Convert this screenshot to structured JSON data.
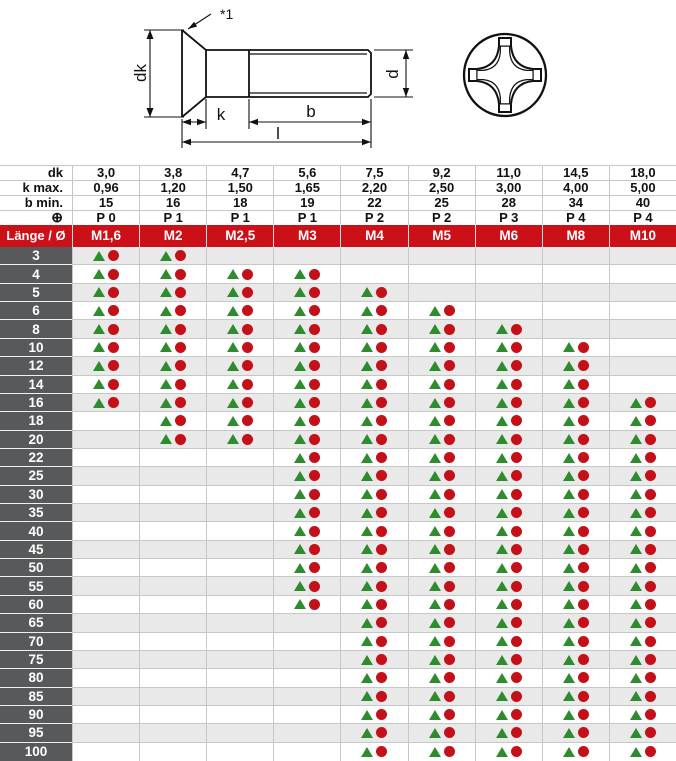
{
  "drawing": {
    "labels": {
      "ref_mark": "*1",
      "dk": "dk",
      "k_dim": "k",
      "b_dim": "b",
      "l_dim": "l",
      "d_dim": "d"
    }
  },
  "table": {
    "spec_rows": [
      {
        "label": "dk",
        "values": [
          "3,0",
          "3,8",
          "4,7",
          "5,6",
          "7,5",
          "9,2",
          "11,0",
          "14,5",
          "18,0"
        ]
      },
      {
        "label": "k max.",
        "values": [
          "0,96",
          "1,20",
          "1,50",
          "1,65",
          "2,20",
          "2,50",
          "3,00",
          "4,00",
          "5,00"
        ]
      },
      {
        "label": "b min.",
        "values": [
          "15",
          "16",
          "18",
          "19",
          "22",
          "25",
          "28",
          "34",
          "40"
        ]
      },
      {
        "label": "⊕",
        "values": [
          "P 0",
          "P 1",
          "P 1",
          "P 1",
          "P 2",
          "P 2",
          "P 3",
          "P 4",
          "P 4"
        ]
      }
    ],
    "header": {
      "corner": "Länge / Ø",
      "columns": [
        "M1,6",
        "M2",
        "M2,5",
        "M3",
        "M4",
        "M5",
        "M6",
        "M8",
        "M10"
      ]
    },
    "rows": [
      {
        "length": "3",
        "marks": [
          1,
          1,
          0,
          0,
          0,
          0,
          0,
          0,
          0
        ]
      },
      {
        "length": "4",
        "marks": [
          1,
          1,
          1,
          1,
          0,
          0,
          0,
          0,
          0
        ]
      },
      {
        "length": "5",
        "marks": [
          1,
          1,
          1,
          1,
          1,
          0,
          0,
          0,
          0
        ]
      },
      {
        "length": "6",
        "marks": [
          1,
          1,
          1,
          1,
          1,
          1,
          0,
          0,
          0
        ]
      },
      {
        "length": "8",
        "marks": [
          1,
          1,
          1,
          1,
          1,
          1,
          1,
          0,
          0
        ]
      },
      {
        "length": "10",
        "marks": [
          1,
          1,
          1,
          1,
          1,
          1,
          1,
          1,
          0
        ]
      },
      {
        "length": "12",
        "marks": [
          1,
          1,
          1,
          1,
          1,
          1,
          1,
          1,
          0
        ]
      },
      {
        "length": "14",
        "marks": [
          1,
          1,
          1,
          1,
          1,
          1,
          1,
          1,
          0
        ]
      },
      {
        "length": "16",
        "marks": [
          1,
          1,
          1,
          1,
          1,
          1,
          1,
          1,
          1
        ]
      },
      {
        "length": "18",
        "marks": [
          0,
          1,
          1,
          1,
          1,
          1,
          1,
          1,
          1
        ]
      },
      {
        "length": "20",
        "marks": [
          0,
          1,
          1,
          1,
          1,
          1,
          1,
          1,
          1
        ]
      },
      {
        "length": "22",
        "marks": [
          0,
          0,
          0,
          1,
          1,
          1,
          1,
          1,
          1
        ]
      },
      {
        "length": "25",
        "marks": [
          0,
          0,
          0,
          1,
          1,
          1,
          1,
          1,
          1
        ]
      },
      {
        "length": "30",
        "marks": [
          0,
          0,
          0,
          1,
          1,
          1,
          1,
          1,
          1
        ]
      },
      {
        "length": "35",
        "marks": [
          0,
          0,
          0,
          1,
          1,
          1,
          1,
          1,
          1
        ]
      },
      {
        "length": "40",
        "marks": [
          0,
          0,
          0,
          1,
          1,
          1,
          1,
          1,
          1
        ]
      },
      {
        "length": "45",
        "marks": [
          0,
          0,
          0,
          1,
          1,
          1,
          1,
          1,
          1
        ]
      },
      {
        "length": "50",
        "marks": [
          0,
          0,
          0,
          1,
          1,
          1,
          1,
          1,
          1
        ]
      },
      {
        "length": "55",
        "marks": [
          0,
          0,
          0,
          1,
          1,
          1,
          1,
          1,
          1
        ]
      },
      {
        "length": "60",
        "marks": [
          0,
          0,
          0,
          1,
          1,
          1,
          1,
          1,
          1
        ]
      },
      {
        "length": "65",
        "marks": [
          0,
          0,
          0,
          0,
          1,
          1,
          1,
          1,
          1
        ]
      },
      {
        "length": "70",
        "marks": [
          0,
          0,
          0,
          0,
          1,
          1,
          1,
          1,
          1
        ]
      },
      {
        "length": "75",
        "marks": [
          0,
          0,
          0,
          0,
          1,
          1,
          1,
          1,
          1
        ]
      },
      {
        "length": "80",
        "marks": [
          0,
          0,
          0,
          0,
          1,
          1,
          1,
          1,
          1
        ]
      },
      {
        "length": "85",
        "marks": [
          0,
          0,
          0,
          0,
          1,
          1,
          1,
          1,
          1
        ]
      },
      {
        "length": "90",
        "marks": [
          0,
          0,
          0,
          0,
          1,
          1,
          1,
          1,
          1
        ]
      },
      {
        "length": "95",
        "marks": [
          0,
          0,
          0,
          0,
          1,
          1,
          1,
          1,
          1
        ]
      },
      {
        "length": "100",
        "marks": [
          0,
          0,
          0,
          0,
          1,
          1,
          1,
          1,
          1
        ]
      }
    ]
  },
  "colors": {
    "header_red": "#cb1017",
    "row_label_gray": "#58595b",
    "row_alt_gray": "#e9e9e9",
    "marker_green": "#2e8b2e",
    "marker_red": "#c41019"
  }
}
